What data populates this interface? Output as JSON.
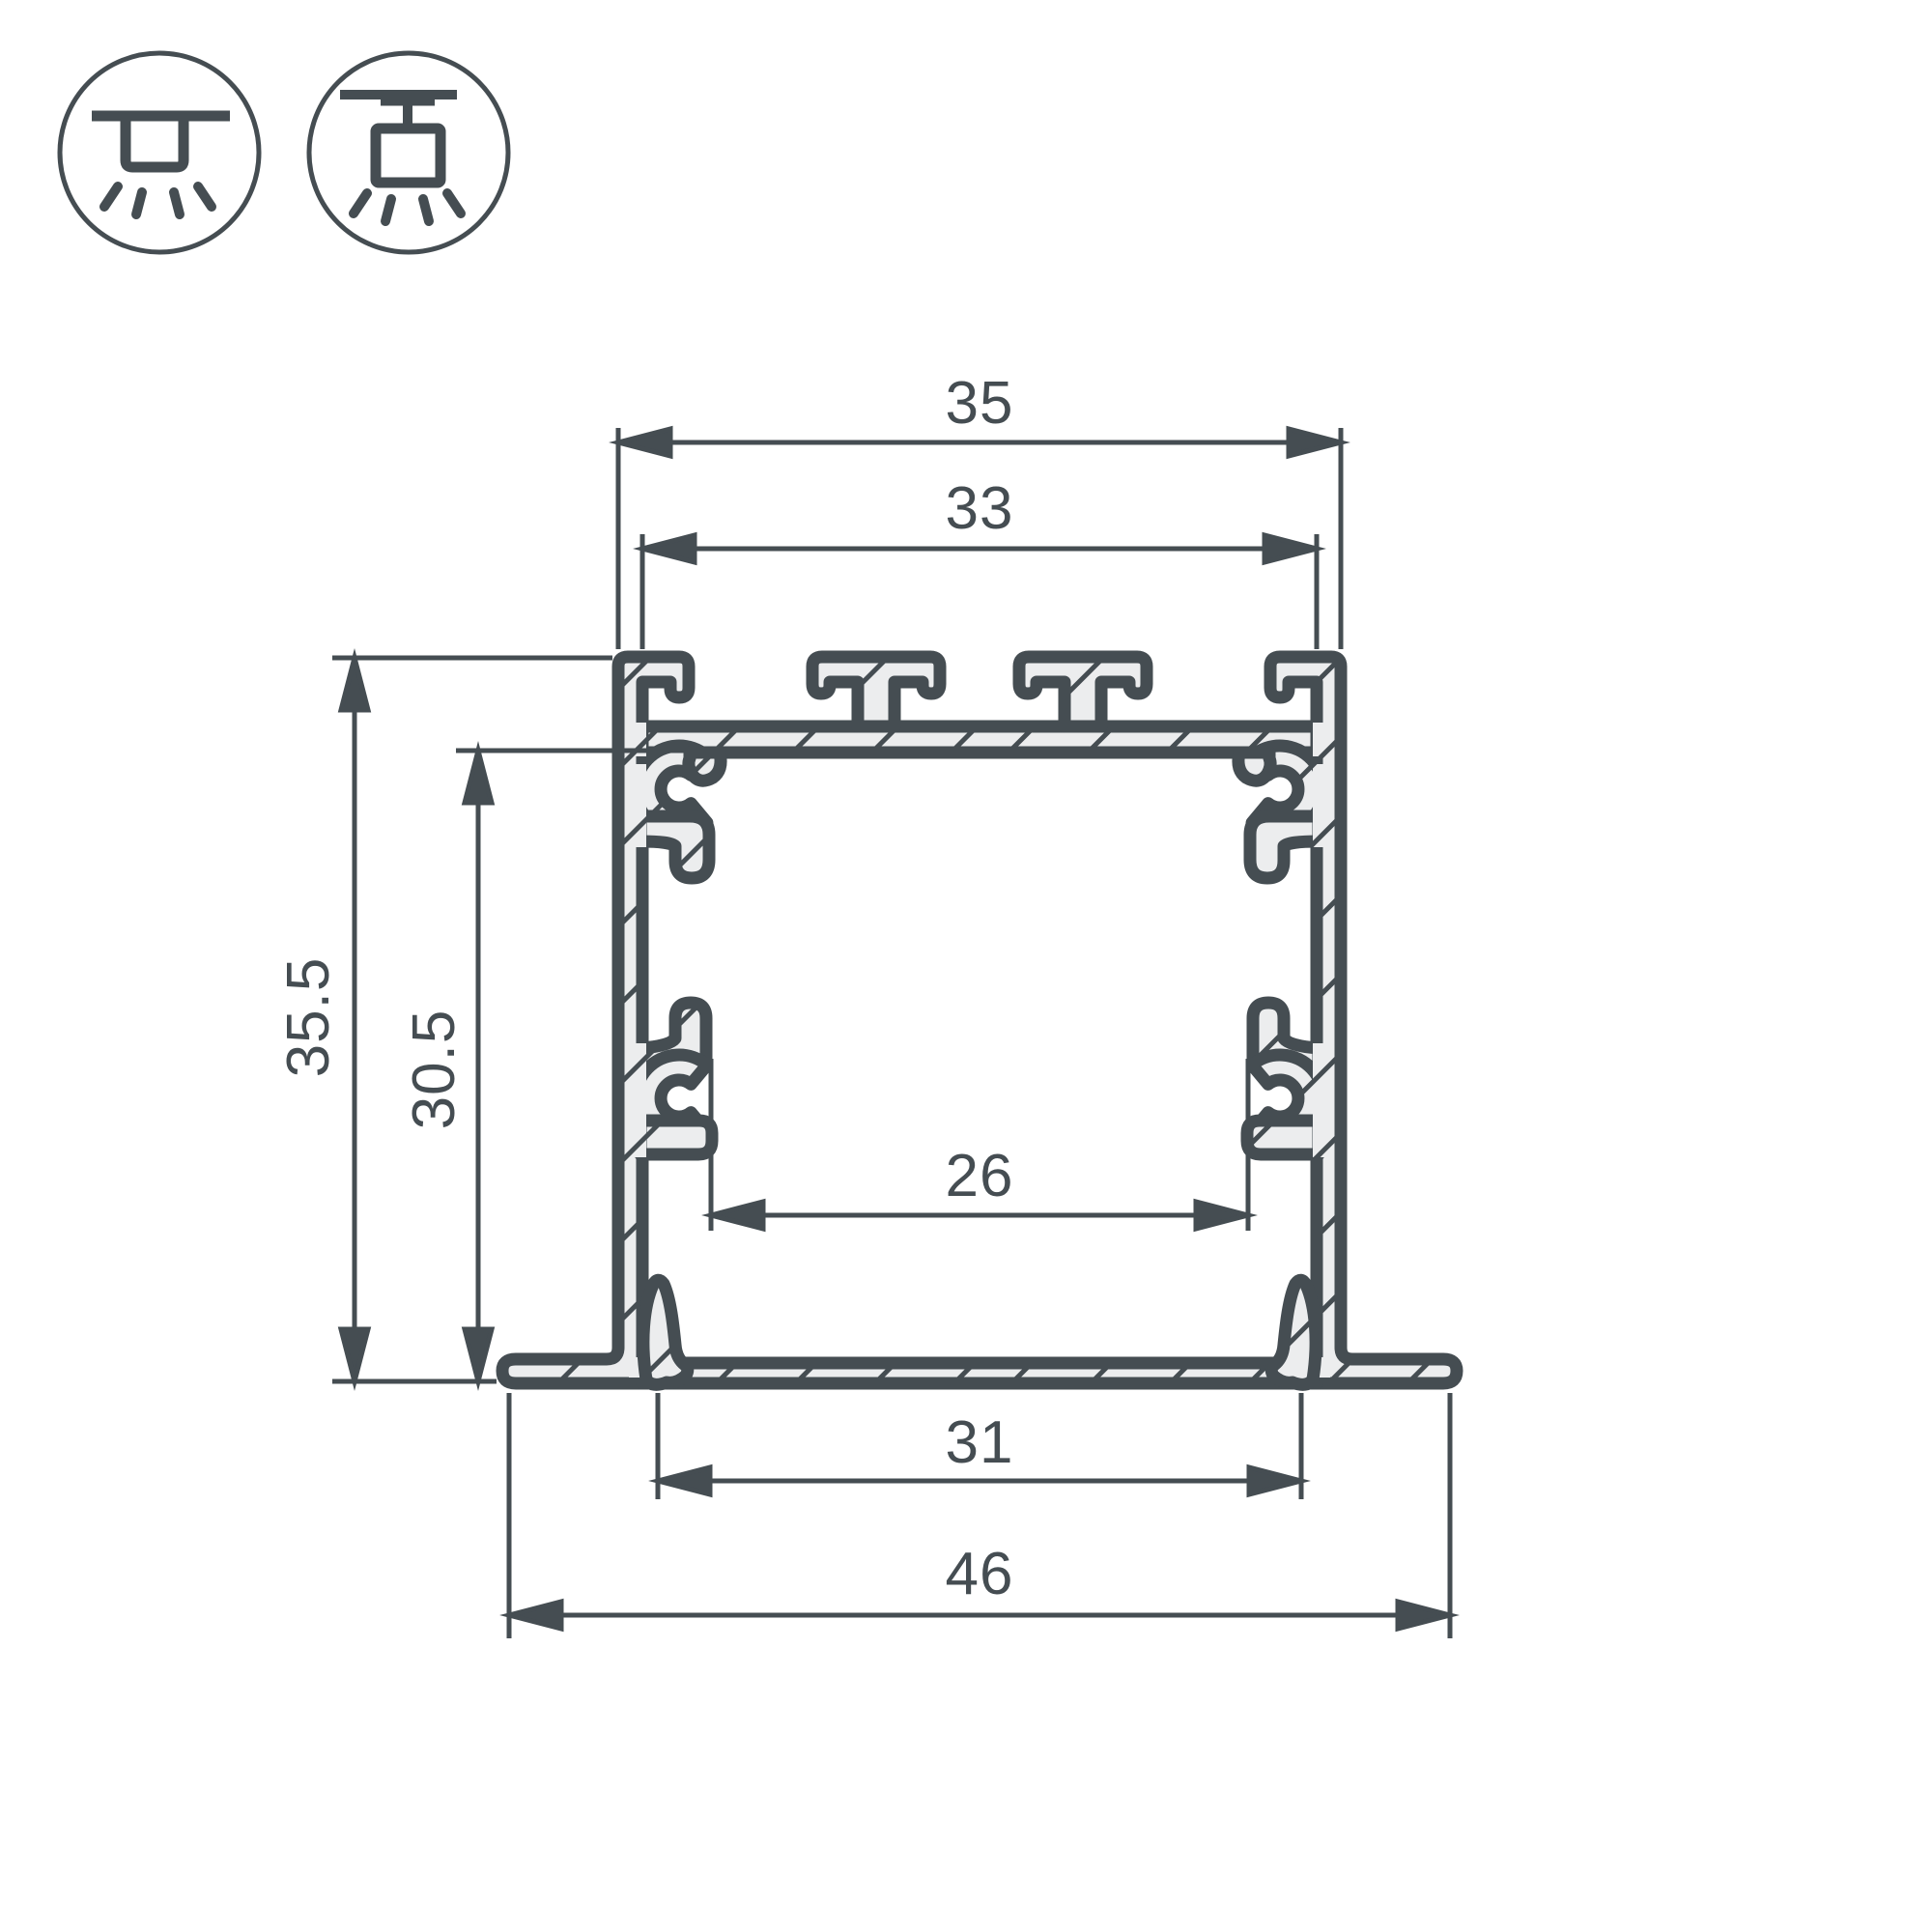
{
  "page": {
    "background": "#ffffff"
  },
  "drawing": {
    "kind": "aluminium LED profile cross-section, recessed mounting",
    "line_color": "#454d52",
    "hatch_fill": "#ecedee"
  },
  "icons": {
    "recessed": {
      "name": "recessed-mount-icon"
    },
    "surface": {
      "name": "surface-mount-icon"
    }
  },
  "dimensions": {
    "outer_width": {
      "value": "35"
    },
    "top_opening_width": {
      "value": "33"
    },
    "overall_height": {
      "value": "35.5"
    },
    "inner_height": {
      "value": "30.5"
    },
    "inner_width": {
      "value": "26"
    },
    "recess_width": {
      "value": "31"
    },
    "flange_width": {
      "value": "46"
    }
  }
}
